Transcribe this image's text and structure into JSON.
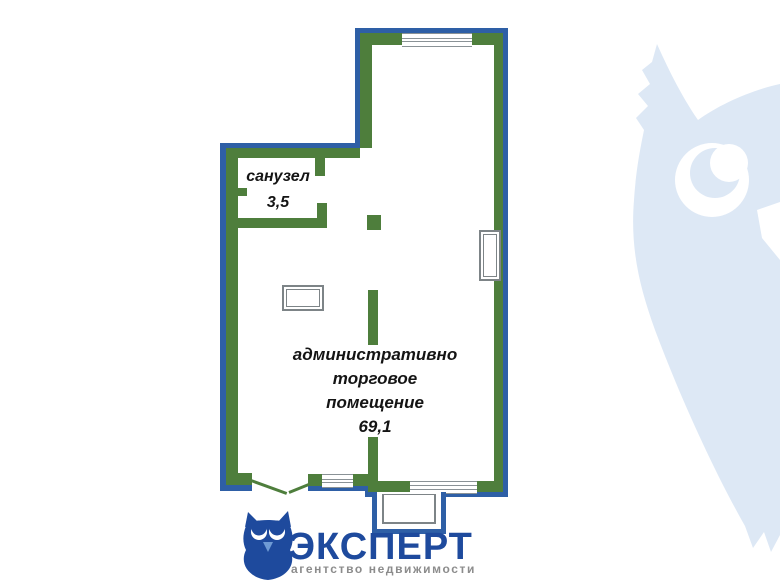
{
  "floorplan": {
    "wc_room": {
      "label": "санузел",
      "area": "3,5"
    },
    "main_room": {
      "label_line1": "административно",
      "label_line2": "торговое",
      "label_line3": "помещение",
      "area": "69,1"
    }
  },
  "logo": {
    "brand": "ЭКСПЕРТ",
    "tagline": "агентство недвижимости"
  },
  "icons": {
    "logo_owl": "owl-logo-icon",
    "watermark_owl": "owl-watermark-icon"
  },
  "colors": {
    "wall_green": "#4e7e3c",
    "wall_blue": "#2e5fa6",
    "window_line_gray": "#8a9296",
    "fixture_gray": "#7d8487",
    "logo_blue": "#1e4a9d",
    "logo_beak_blue": "#6f9bd4",
    "tagline_gray": "#8c8c8c",
    "watermark_blue": "#dde8f5",
    "text_black": "#141414"
  }
}
